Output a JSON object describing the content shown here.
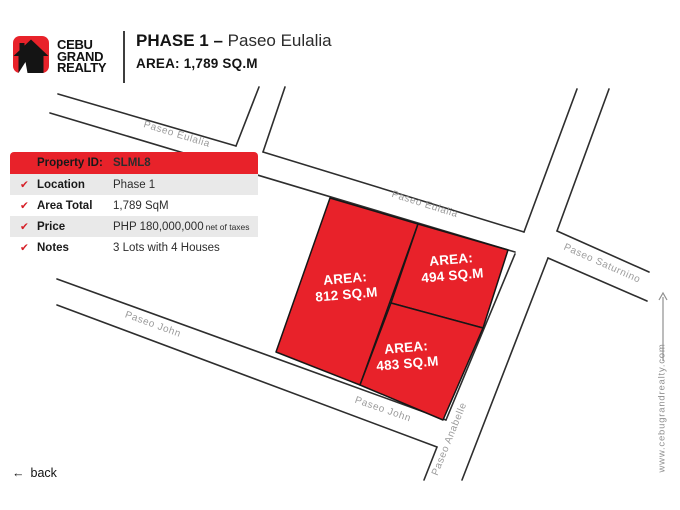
{
  "header": {
    "brand": {
      "line1": "CEBU",
      "line2": "GRAND",
      "line3": "REALTY"
    },
    "title_bold": "PHASE 1",
    "title_sep": " – ",
    "title_rest": "Paseo Eulalia",
    "subtitle": "AREA: 1,789 SQ.M"
  },
  "property_table": {
    "check_glyph": "✔",
    "header": {
      "label": "Property ID:",
      "value": "SLML8"
    },
    "rows": [
      {
        "label": "Location",
        "value": "Phase 1"
      },
      {
        "label": "Area Total",
        "value": "1,789 SqM"
      },
      {
        "label": "Price",
        "value": "PHP 180,000,000",
        "value_note": "net of taxes"
      },
      {
        "label": "Notes",
        "value": "3 Lots with 4 Houses"
      }
    ]
  },
  "map": {
    "street_labels": [
      {
        "text": "Paseo Eulalia"
      },
      {
        "text": "Paseo Eulalia"
      },
      {
        "text": "Paseo Saturnino"
      },
      {
        "text": "Paseo John"
      },
      {
        "text": "Paseo John"
      },
      {
        "text": "Paseo Anabelle"
      }
    ],
    "lots": [
      {
        "label_prefix": "AREA:",
        "area_text": "812 SQ.M"
      },
      {
        "label_prefix": "AREA:",
        "area_text": "494 SQ.M"
      },
      {
        "label_prefix": "AREA:",
        "area_text": "483 SQ.M"
      }
    ]
  },
  "sidebar": {
    "website": "www.cebugrandrealty.com",
    "arrow": "↑"
  },
  "footer": {
    "back_arrow": "←",
    "back_label": "back"
  },
  "colors": {
    "red": "#e8222a",
    "street_line": "#2e2e2e",
    "street_label_gray": "#9b9b9b",
    "table_alt_row": "#e9e9e9",
    "text_black": "#141414"
  }
}
